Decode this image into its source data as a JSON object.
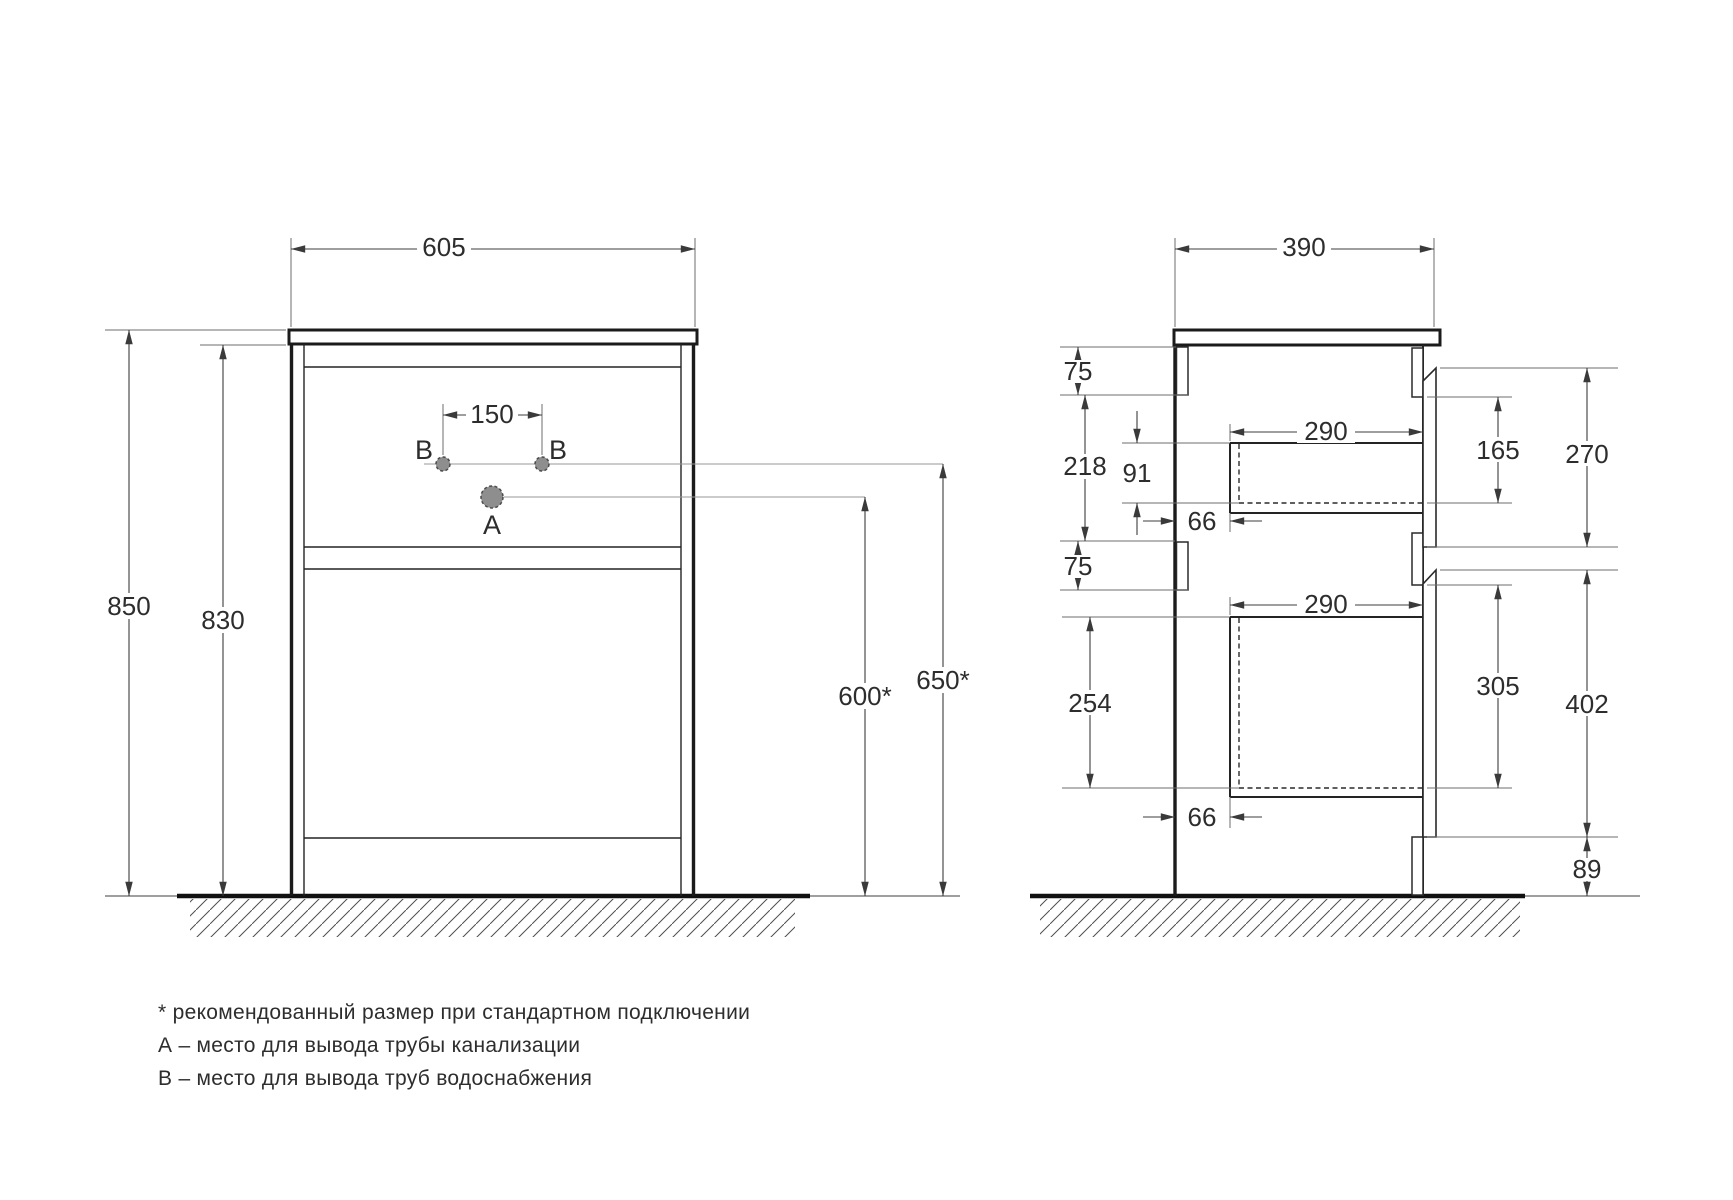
{
  "front_view": {
    "width": "605",
    "height_total": "850",
    "height_body": "830",
    "holes_spacing": "150",
    "drain_outlet_height": "600*",
    "water_outlet_height": "650*",
    "hole_a": "A",
    "hole_b": "B"
  },
  "side_view": {
    "depth": "390",
    "top_rail_height": "75",
    "back_top_gap": "218",
    "drawer1_inner_height": "91",
    "drawer1_depth": "290",
    "drawer1_back_gap": "66",
    "drawer1_box_height": "165",
    "drawer1_front_height": "270",
    "mid_rail_height": "75",
    "drawer2_inner_height": "254",
    "drawer2_depth": "290",
    "drawer2_box_height": "305",
    "drawer2_front_height": "402",
    "drawer2_back_gap": "66",
    "plinth_height": "89"
  },
  "footnotes": [
    "* рекомендованный размер при стандартном подключении",
    "А – место для вывода трубы канализации",
    "В – место для вывода труб водоснабжения"
  ]
}
